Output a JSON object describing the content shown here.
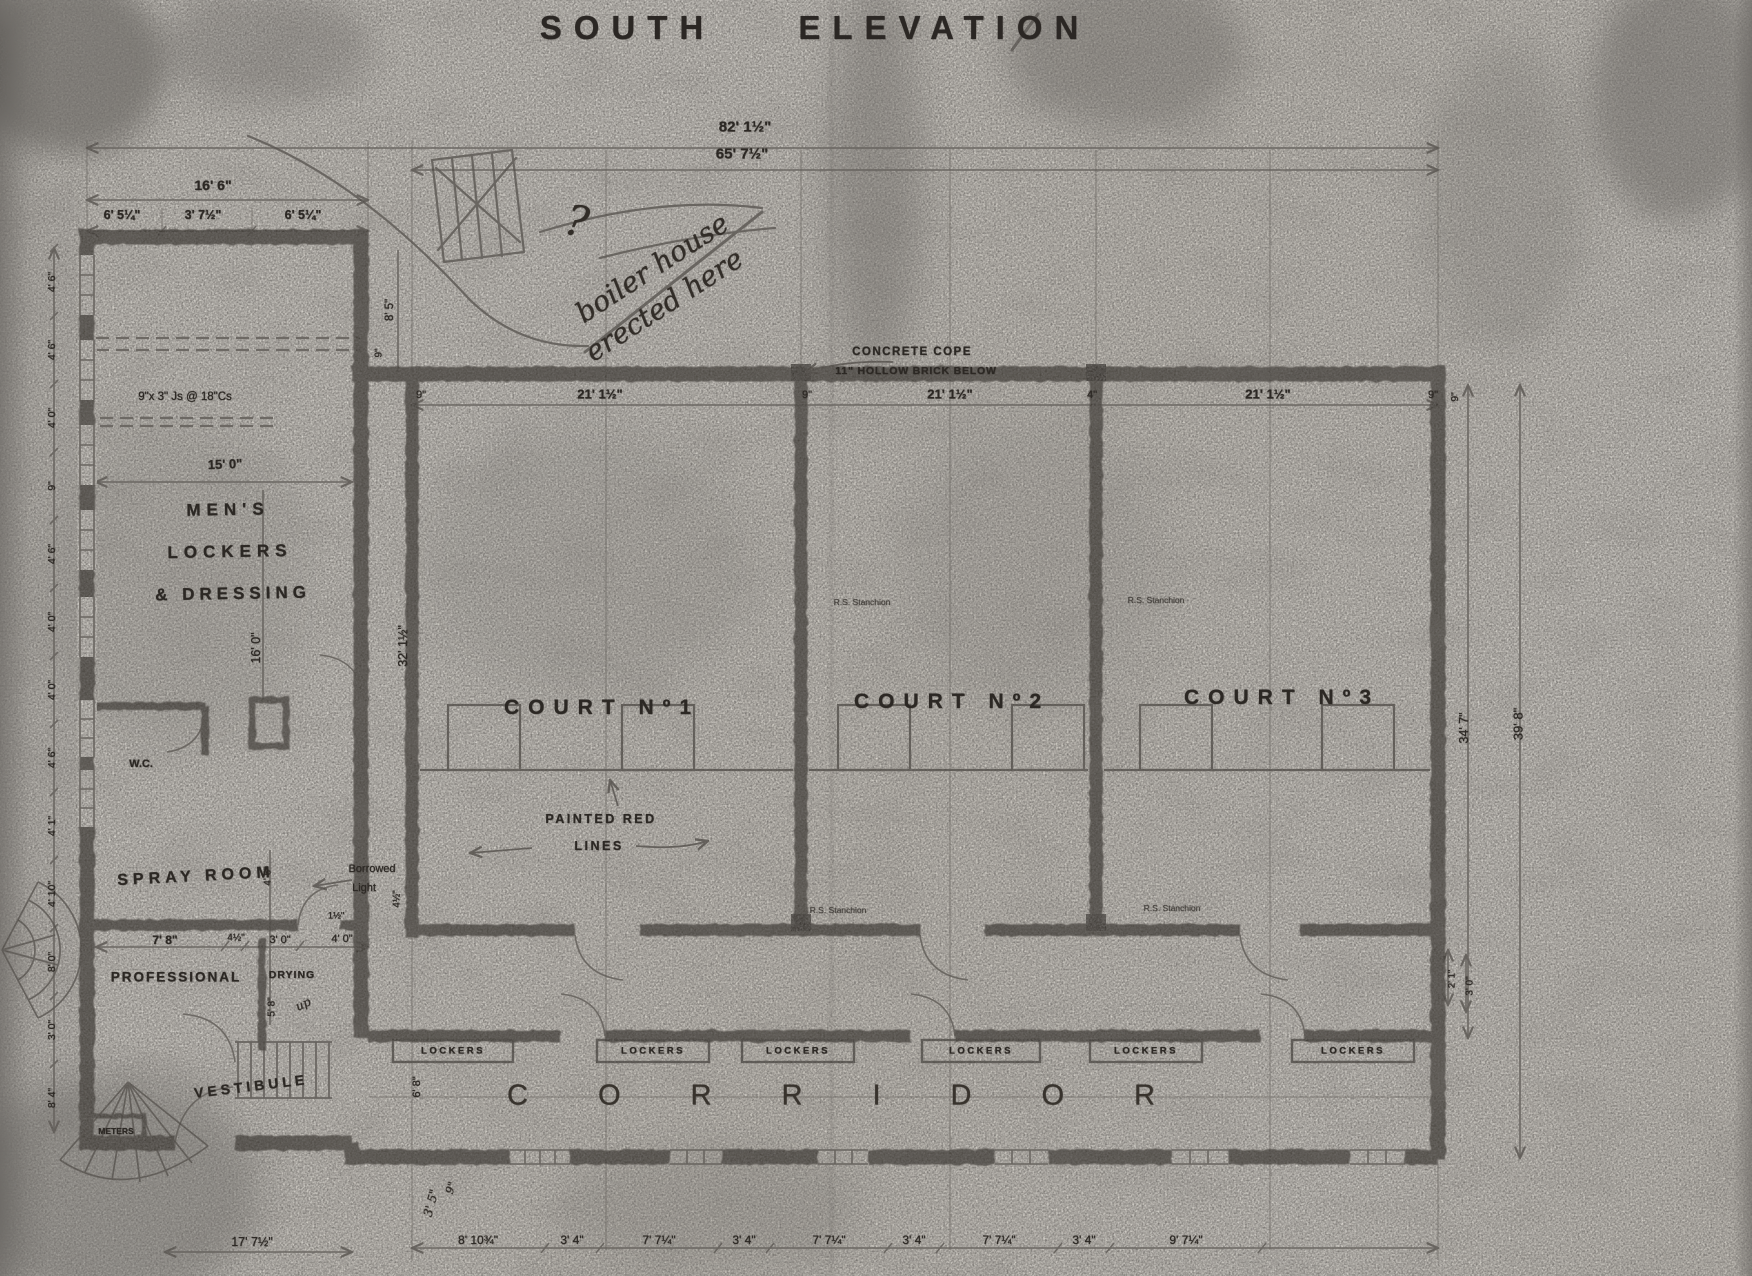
{
  "title": "SOUTH ELEVATION",
  "colors": {
    "paper": "#eeeae2",
    "ink": "#2c2824",
    "wall": "#27231e"
  },
  "rooms": {
    "mens_line1": "MEN'S",
    "mens_line2": "LOCKERS",
    "mens_line3": "& DRESSING",
    "wc": "W.C.",
    "spray": "SPRAY ROOM",
    "professional": "PROFESSIONAL",
    "drying": "DRYING",
    "vestibule": "VESTIBULE",
    "meters": "METERS",
    "court1": "COURT Nº1",
    "court2": "COURT Nº2",
    "court3": "COURT Nº3",
    "corridor": "CORRIDOR",
    "lockers": [
      "LOCKERS",
      "LOCKERS",
      "LOCKERS",
      "LOCKERS",
      "LOCKERS",
      "LOCKERS"
    ]
  },
  "annotations": {
    "concrete_cope_line1": "CONCRETE COPE",
    "concrete_cope_line2": "11\" HOLLOW BRICK BELOW",
    "painted_red_line1": "PAINTED RED",
    "painted_red_line2": "LINES",
    "borrowed_line1": "Borrowed",
    "borrowed_line2": "Light",
    "joists": "9\"x 3\" Js @ 18\"Cs",
    "stanchion": "R.S. Stanchion",
    "note_q": "?",
    "note_line1": "boiler house",
    "note_line2": "erected here",
    "up": "up"
  },
  "dims": {
    "overall": "82' 1½\"",
    "courts_span": "65' 7½\"",
    "wing": "16' 6\"",
    "wing_parts": [
      "6' 5¼\"",
      "3' 7½\"",
      "6' 5¼\""
    ],
    "court_top": [
      "9\"",
      "21' 1½\"",
      "9\"",
      "21' 1½\"",
      "4\"",
      "21' 1½\"",
      "9\""
    ],
    "left_chain": [
      "4' 6\"",
      "4' 6\"",
      "4' 0\"",
      "9\"",
      "4' 6\"",
      "4' 0\"",
      "4' 0\"",
      "4' 6\"",
      "4' 1\"",
      "4' 10\"",
      "8' 0\"",
      "3' 0\"",
      "8' 4\""
    ],
    "wing_width": "15' 0\"",
    "wing_height": "16' 0\"",
    "court_height": "32' 1½\"",
    "d8_5": "8' 5\"",
    "d9_top": "9\"",
    "spray_row": [
      "7' 8\"",
      "4½\"",
      "3' 0\"",
      "4' 0\""
    ],
    "d1_5": "1½\"",
    "d4_6_v": "4' 6\"",
    "d5_8": "5' 8\"",
    "d4_5_v": "4½\"",
    "d6_8": "6' 8\"",
    "d3_5": "3' 5\"",
    "d9_hand": "9\"",
    "right_9": "9\"",
    "right_34": "34' 7\"",
    "right_39": "39' 8\"",
    "right_2_1": "2' 1\"",
    "right_3_0": "3' 0\"",
    "bottom_row": [
      "8' 10¾\"",
      "3' 4\"",
      "7' 7¼\"",
      "3' 4\"",
      "7' 7¼\"",
      "3' 4\"",
      "7' 7¼\"",
      "3' 4\"",
      "9' 7¼\""
    ],
    "bottom_left": "17' 7½\""
  }
}
